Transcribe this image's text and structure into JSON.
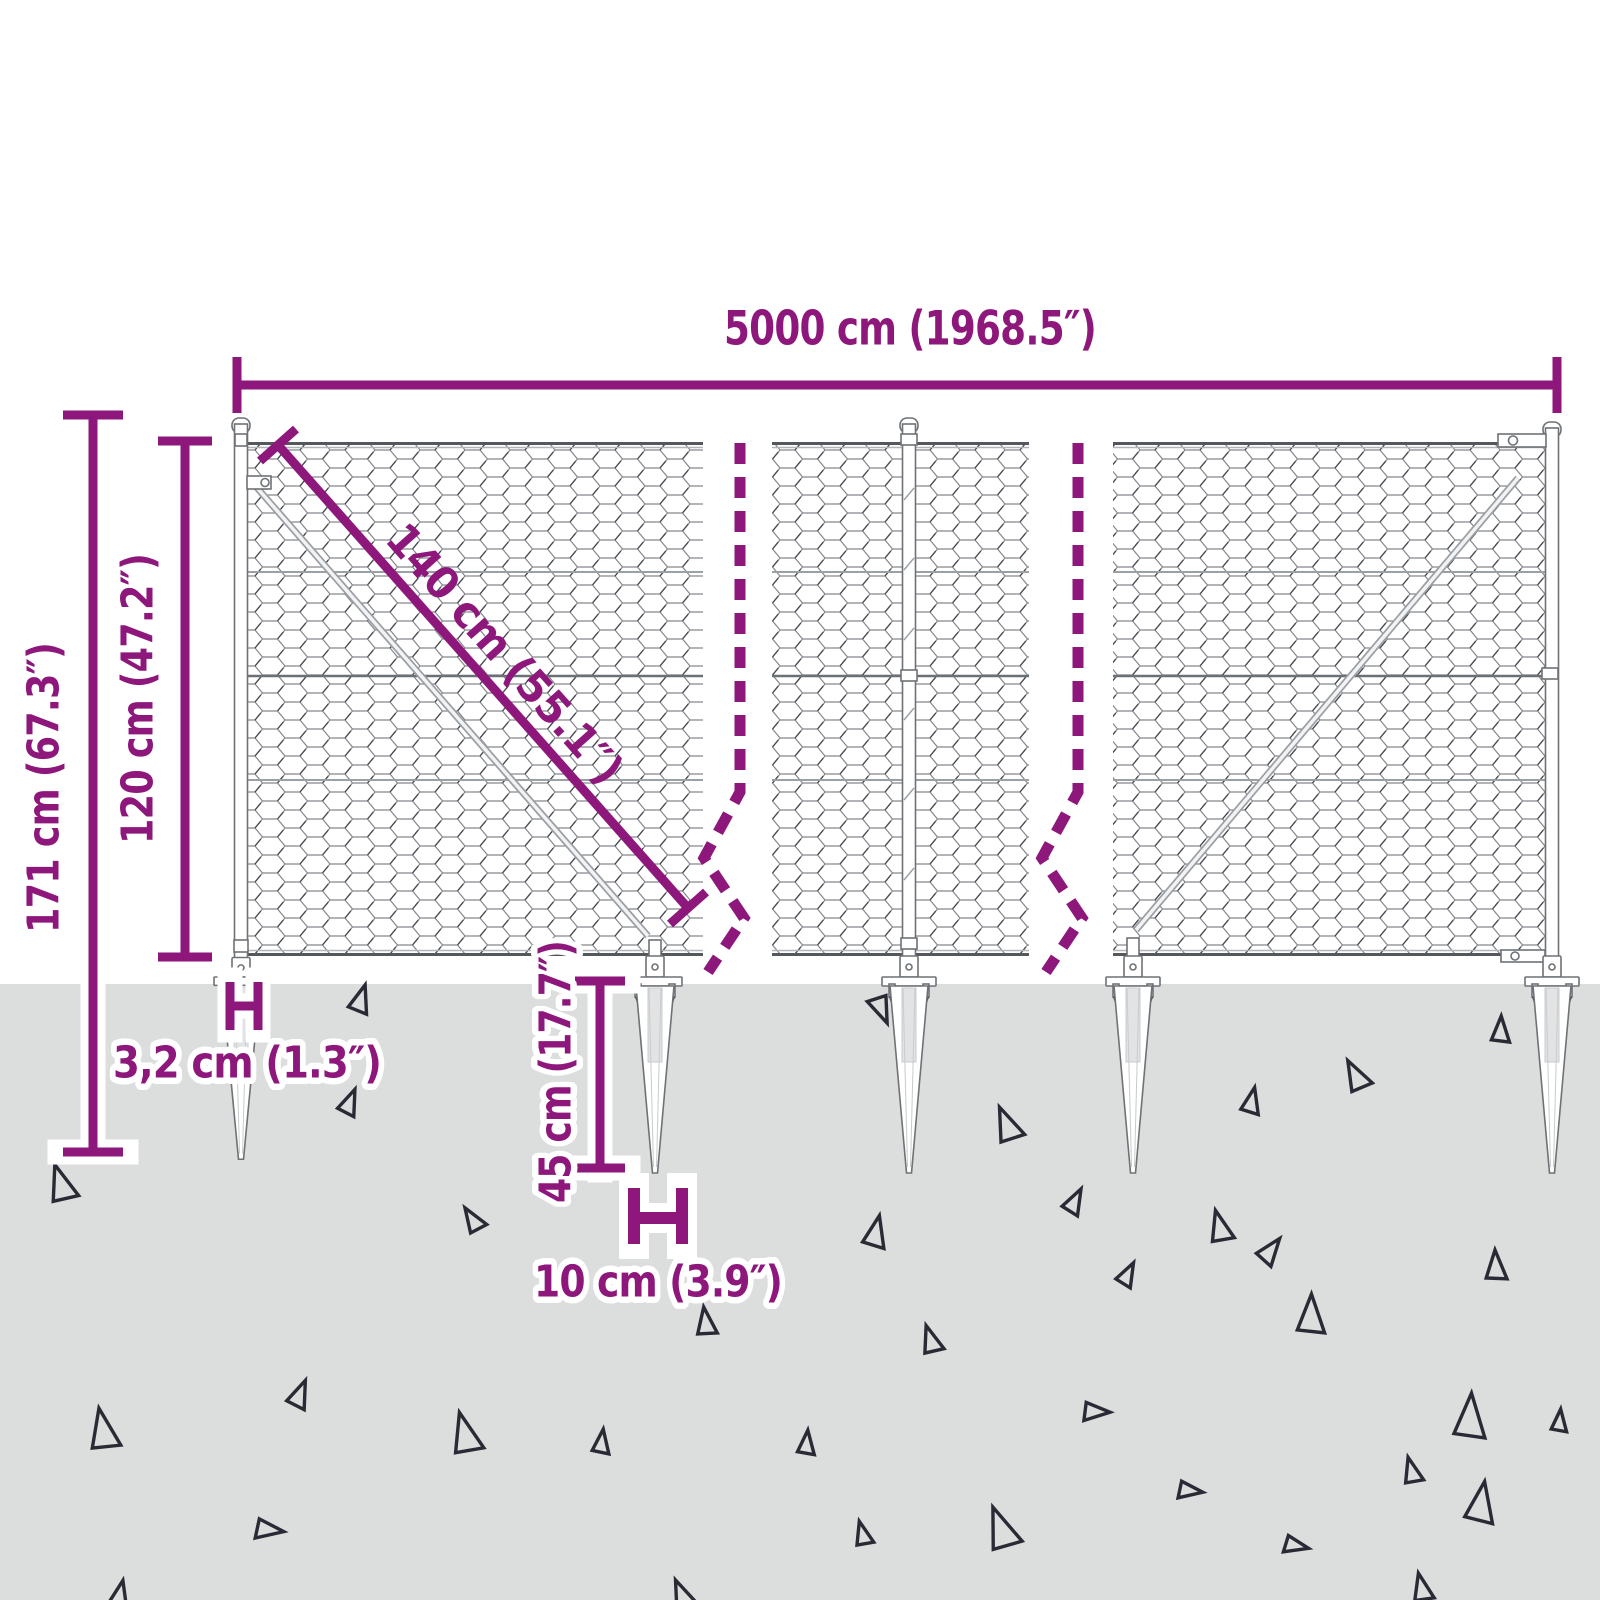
{
  "diagram": {
    "type": "product-dimension-diagram",
    "subject": "chain-link mesh fence with spike ground anchors",
    "labels": {
      "total_width": "5000 cm (1968.5″)",
      "total_height": "171 cm (67.3″)",
      "fence_height": "120 cm (47.2″)",
      "mesh_diagonal": "140 cm (55.1″)",
      "post_width": "3,2 cm (1.3″)",
      "spike_length": "45 cm (17.7″)",
      "spike_width": "10 cm (3.9″)"
    },
    "colors": {
      "dimension_purple": "#8e177c",
      "ground_gray": "#dcdddd",
      "wire_gray": "#84888c",
      "triangle_outline": "#2a2a35",
      "background": "#ffffff"
    }
  },
  "decor": {
    "triangles": [
      {
        "x": 360,
        "y": 999,
        "s": 15,
        "r": 20
      },
      {
        "x": 882,
        "y": 1009,
        "s": 15,
        "r": 160
      },
      {
        "x": 1500,
        "y": 1030,
        "s": 14,
        "r": 5
      },
      {
        "x": 1355,
        "y": 1076,
        "s": 17,
        "r": -25
      },
      {
        "x": 1251,
        "y": 1101,
        "s": 14,
        "r": 15
      },
      {
        "x": 349,
        "y": 1102,
        "s": 14,
        "r": 25
      },
      {
        "x": 1006,
        "y": 1125,
        "s": 19,
        "r": -20
      },
      {
        "x": 60,
        "y": 1184,
        "s": 20,
        "r": -15
      },
      {
        "x": 1074,
        "y": 1201,
        "s": 14,
        "r": 30
      },
      {
        "x": 472,
        "y": 1220,
        "s": 14,
        "r": -30
      },
      {
        "x": 1219,
        "y": 1227,
        "s": 17,
        "r": -12
      },
      {
        "x": 875,
        "y": 1232,
        "s": 17,
        "r": 15
      },
      {
        "x": 1270,
        "y": 1250,
        "s": 15,
        "r": 40
      },
      {
        "x": 1495,
        "y": 1266,
        "s": 16,
        "r": 0
      },
      {
        "x": 1127,
        "y": 1274,
        "s": 13,
        "r": 30
      },
      {
        "x": 705,
        "y": 1322,
        "s": 15,
        "r": -5
      },
      {
        "x": 930,
        "y": 1340,
        "s": 15,
        "r": -15
      },
      {
        "x": 1310,
        "y": 1315,
        "s": 21,
        "r": 4
      },
      {
        "x": 299,
        "y": 1394,
        "s": 15,
        "r": 25
      },
      {
        "x": 102,
        "y": 1430,
        "s": 22,
        "r": -8
      },
      {
        "x": 464,
        "y": 1434,
        "s": 22,
        "r": -12
      },
      {
        "x": 601,
        "y": 1442,
        "s": 13,
        "r": 10
      },
      {
        "x": 1096,
        "y": 1411,
        "s": 14,
        "r": 95
      },
      {
        "x": 806,
        "y": 1443,
        "s": 13,
        "r": 8
      },
      {
        "x": 1411,
        "y": 1471,
        "s": 14,
        "r": -12
      },
      {
        "x": 1469,
        "y": 1417,
        "s": 24,
        "r": 6
      },
      {
        "x": 1480,
        "y": 1503,
        "s": 22,
        "r": 12
      },
      {
        "x": 1190,
        "y": 1490,
        "s": 13,
        "r": 100
      },
      {
        "x": 269,
        "y": 1529,
        "s": 15,
        "r": 100
      },
      {
        "x": 862,
        "y": 1534,
        "s": 13,
        "r": -12
      },
      {
        "x": 1000,
        "y": 1529,
        "s": 23,
        "r": -18
      },
      {
        "x": 1296,
        "y": 1545,
        "s": 13,
        "r": 105
      },
      {
        "x": 119,
        "y": 1595,
        "s": 15,
        "r": 15
      },
      {
        "x": 681,
        "y": 1595,
        "s": 16,
        "r": -20
      },
      {
        "x": 1421,
        "y": 1588,
        "s": 15,
        "r": -10
      },
      {
        "x": 1559,
        "y": 1421,
        "s": 12,
        "r": 8
      }
    ]
  }
}
